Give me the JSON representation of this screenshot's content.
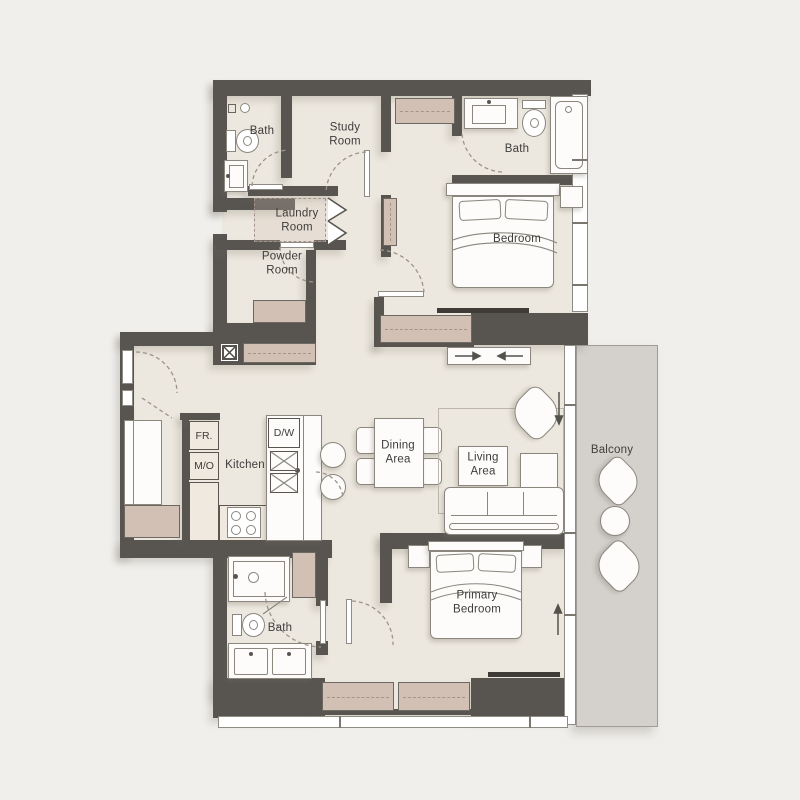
{
  "title": "Two-bedroom apartment floor plan",
  "theme": {
    "background": "#f0efec",
    "floor": "#ede8df",
    "wall": "#585551",
    "closet": "#d2c0b4",
    "closet_dash": "#a3958a",
    "balcony": "#d4d1cd",
    "fixture": "#fdfcfa",
    "fixture_line": "#8b867e",
    "label": "#3e3d3b",
    "dash": "#a49a8d"
  },
  "labels": {
    "bath_top_left": {
      "text": "Bath"
    },
    "study_room": {
      "text": "Study\nRoom"
    },
    "bath_top_right": {
      "text": "Bath"
    },
    "bedroom": {
      "text": "Bedroom"
    },
    "laundry_room": {
      "text": "Laundry\nRoom"
    },
    "powder_room": {
      "text": "Powder\nRoom"
    },
    "fridge": {
      "text": "FR."
    },
    "micro_oven": {
      "text": "M/O"
    },
    "kitchen": {
      "text": "Kitchen"
    },
    "dishwasher": {
      "text": "D/W"
    },
    "dining_area": {
      "text": "Dining\nArea"
    },
    "living_area": {
      "text": "Living\nArea"
    },
    "balcony": {
      "text": "Balcony"
    },
    "primary_bedroom": {
      "text": "Primary\nBedroom"
    },
    "bath_bottom": {
      "text": "Bath"
    }
  }
}
